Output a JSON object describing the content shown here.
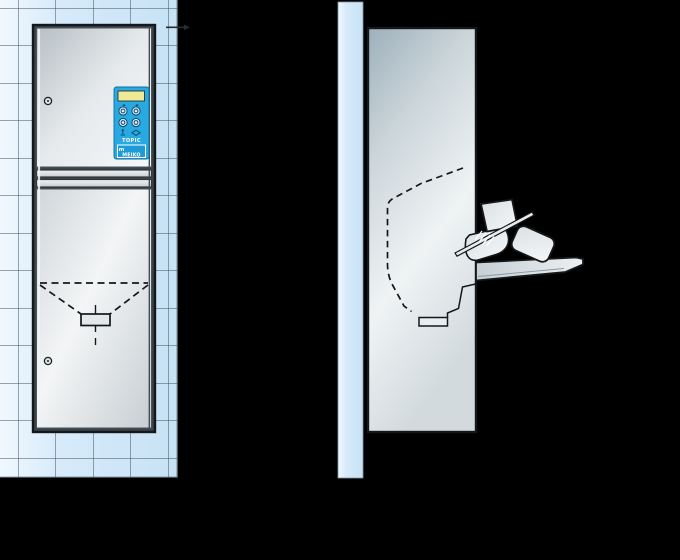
{
  "scene": {
    "description": "technical-illustration",
    "views": [
      "front-view-on-tiled-wall",
      "side-view-with-open-flap"
    ]
  },
  "colors": {
    "background": "#000000",
    "tile_wall": "#d6eafa",
    "tile_grout": "#3f4e57",
    "outline": "#14181a",
    "stainless_light": "#f5f7f8",
    "stainless_dark": "#a8b4bb",
    "panel_blue": "#29a9e1",
    "display_yellow": "#efe895"
  },
  "control_panel": {
    "brand": "TOPIC",
    "logo_initial": "m",
    "logo_text": "MEIKO",
    "display": "lcd-display",
    "button_icons": [
      "program-button-1",
      "program-button-2",
      "program-button-3",
      "program-button-4"
    ],
    "symbol_icons": [
      "user-icon",
      "navigation-diamond-icon"
    ]
  },
  "icons": {
    "lock-icon": "circle-screw-lock",
    "leader-arrow": "thin-arrow-right",
    "bedpan": "tilted-pan-outline",
    "urine-bottle": "rounded-bottle-outline"
  }
}
